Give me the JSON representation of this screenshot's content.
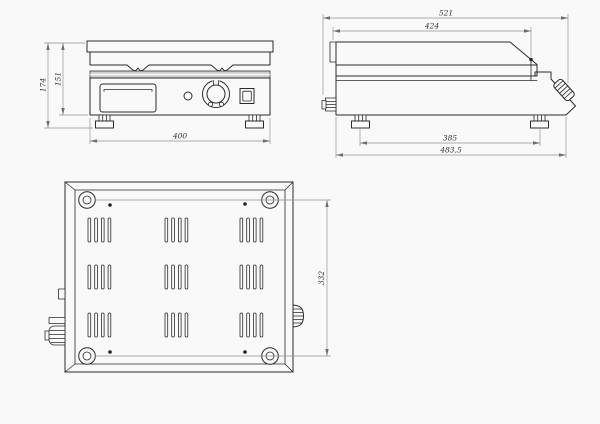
{
  "drawing": {
    "front_view": {
      "total_height": "174",
      "body_height": "151",
      "width": "400"
    },
    "side_view": {
      "overall_length": "521",
      "top_length": "424",
      "feet_spacing": "385",
      "base_length": "483,5"
    },
    "bottom_view": {
      "feet_spacing": "332"
    }
  },
  "colors": {
    "object_line": "#2a2a2a",
    "dimension_line": "#8f8f8f",
    "griddle_band_fill": "#cfcfcf",
    "background": "#f9f9f9"
  }
}
